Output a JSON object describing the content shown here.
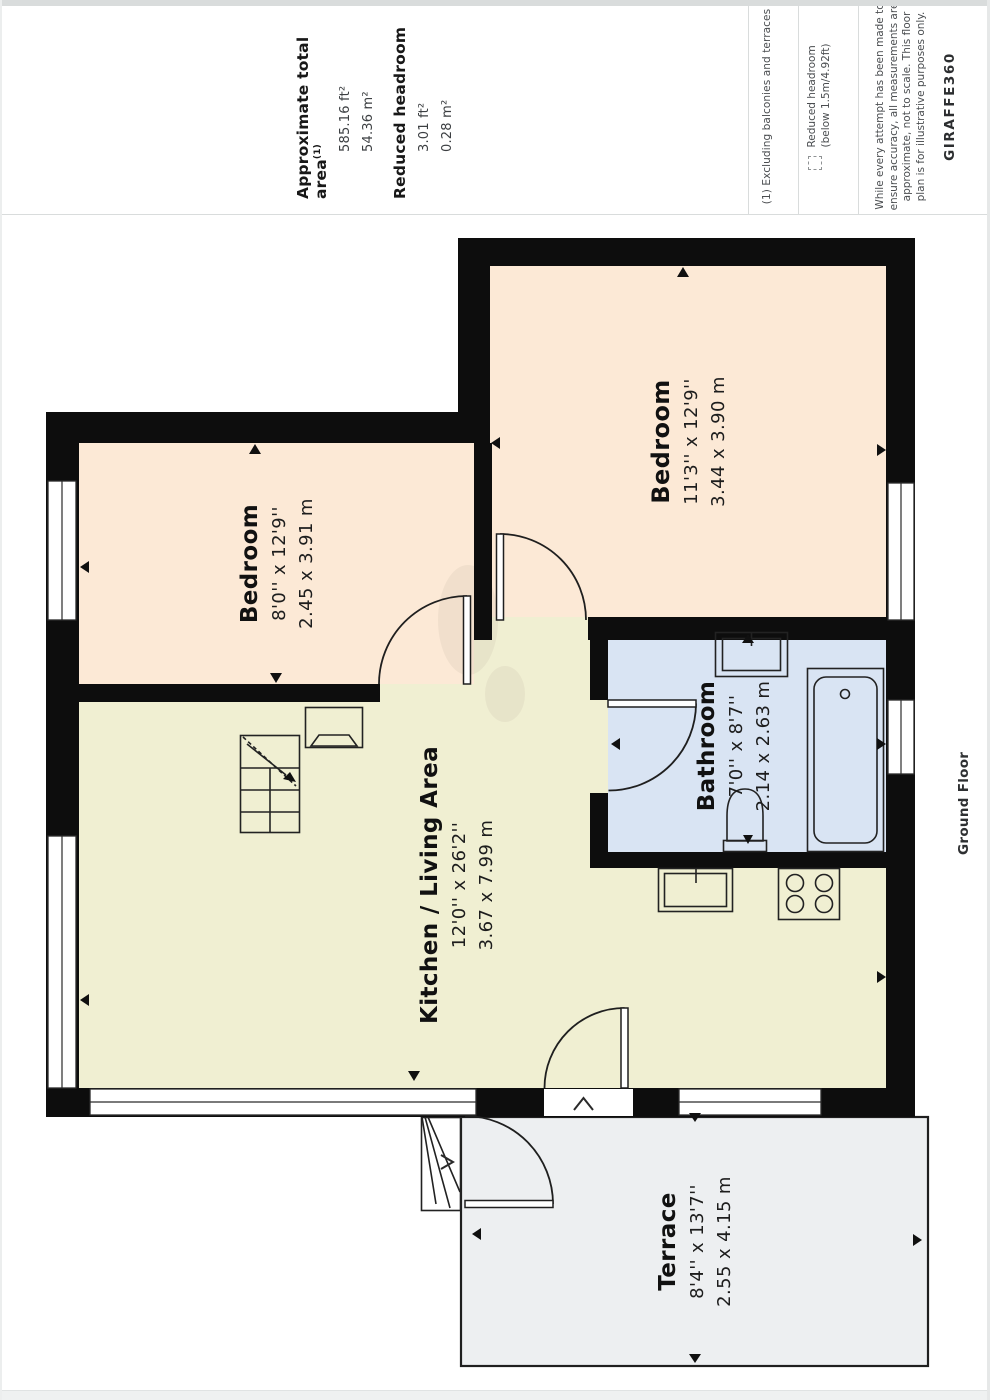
{
  "colors": {
    "wall": "#0d0d0d",
    "bedroom": "#fce9d6",
    "kitchen": "#f0efd2",
    "bathroom": "#d9e4f3",
    "terrace": "#edeff1",
    "divider": "#d9dcdc"
  },
  "header": {
    "total_area": {
      "label": "Approximate total area",
      "footnote_mark": "(1)",
      "value_ft": "585.16 ft²",
      "value_m": "54.36 m²"
    },
    "reduced_headroom": {
      "label": "Reduced headroom",
      "value_ft": "3.01 ft²",
      "value_m": "0.28 m²"
    },
    "footnote": "(1) Excluding balconies and terraces",
    "legend": {
      "icon": "dashed-square-icon",
      "line1": "Reduced headroom",
      "line2": "(below 1.5m/4.92ft)"
    },
    "disclaimer": [
      "While every attempt has been made to",
      "ensure accuracy, all measurements are",
      "approximate, not to scale. This floor",
      "plan is for illustrative purposes only."
    ],
    "brand": "GIRAFFE360"
  },
  "floor_label": "Ground Floor",
  "rooms": [
    {
      "id": "bedroom-left",
      "name": "Bedroom",
      "dims_ft": "8'0'' x 12'9''",
      "dims_m": "2.45 x 3.91 m"
    },
    {
      "id": "bedroom-right",
      "name": "Bedroom",
      "dims_ft": "11'3'' x 12'9''",
      "dims_m": "3.44 x 3.90 m"
    },
    {
      "id": "bathroom",
      "name": "Bathroom",
      "dims_ft": "7'0'' x 8'7''",
      "dims_m": "2.14 x 2.63 m"
    },
    {
      "id": "kitchen",
      "name": "Kitchen / Living Area",
      "dims_ft": "12'0'' x 26'2''",
      "dims_m": "3.67 x 7.99 m"
    },
    {
      "id": "terrace",
      "name": "Terrace",
      "dims_ft": "8'4'' x 13'7''",
      "dims_m": "2.55 x 4.15 m"
    }
  ]
}
